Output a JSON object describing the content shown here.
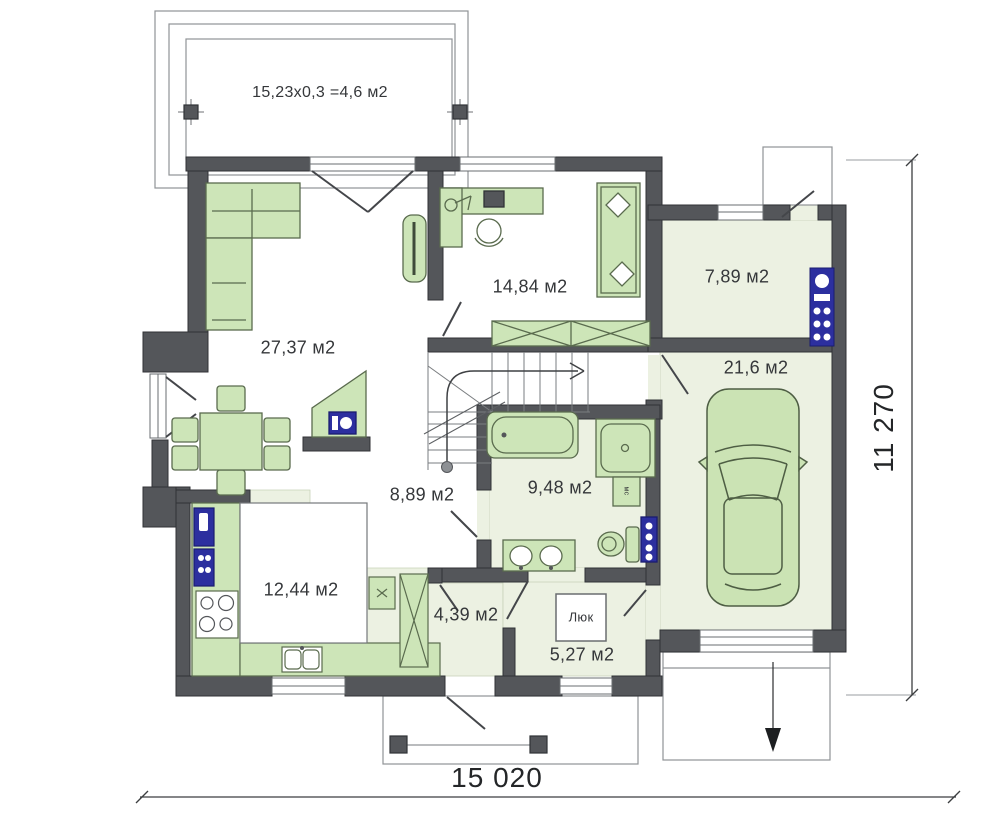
{
  "rooms": [
    {
      "id": "terrace",
      "label": "15,23x0,3 =4,6 м2"
    },
    {
      "id": "living",
      "label": "27,37 м2"
    },
    {
      "id": "office",
      "label": "14,84 м2"
    },
    {
      "id": "boiler",
      "label": "7,89 м2"
    },
    {
      "id": "garage",
      "label": "21,6 м2"
    },
    {
      "id": "hall",
      "label": "8,89 м2"
    },
    {
      "id": "bathroom",
      "label": "9,48 м2"
    },
    {
      "id": "kitchen",
      "label": "12,44 м2"
    },
    {
      "id": "hallway",
      "label": "4,39 м2"
    },
    {
      "id": "entry",
      "label": "5,27 м2"
    }
  ],
  "annotations": {
    "hatch": "Люк",
    "washer": "мс"
  },
  "dimensions": {
    "width": "15 020",
    "height": "11 270"
  },
  "colors": {
    "wall": "#54565a",
    "floor_green": "#ecf1e2",
    "furniture_green": "#cde5b8",
    "appliance_blue": "#2c2f9f",
    "outline_gray": "#909396"
  }
}
